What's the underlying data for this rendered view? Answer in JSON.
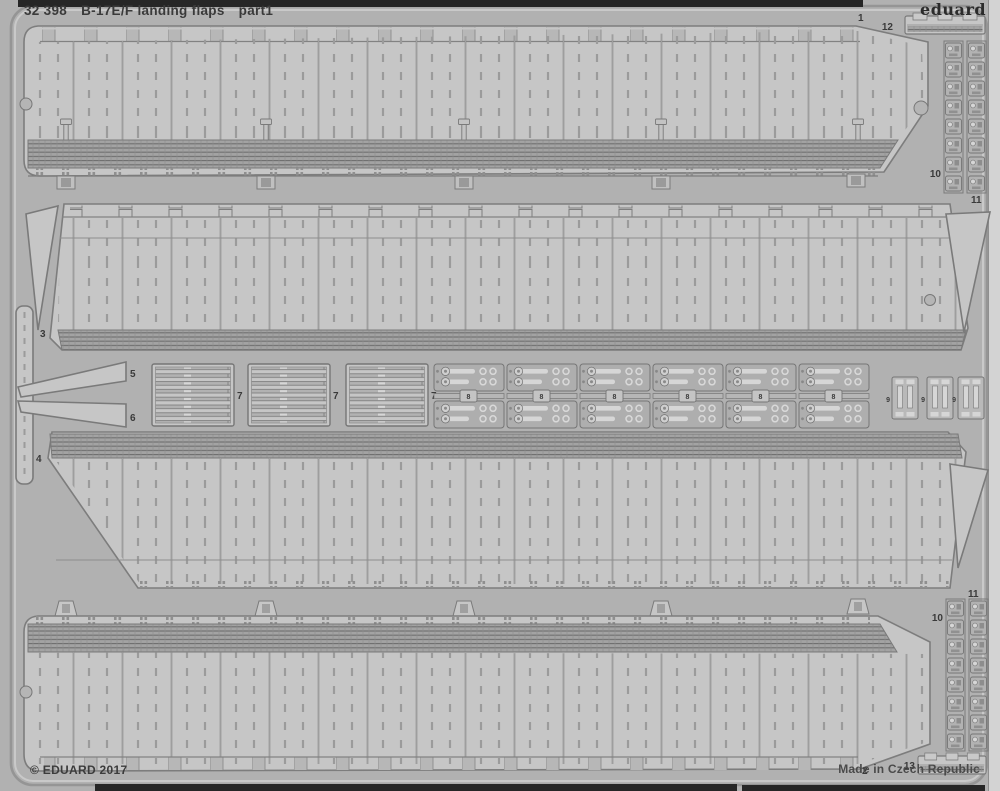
{
  "header": {
    "catalog_no": "32 398",
    "title": "B-17E/F landing flaps",
    "part_no": "part1"
  },
  "brand": {
    "logo": "eduard"
  },
  "footer": {
    "copyright": "© EDUARD 2017",
    "made_in": "Made in Czech Republic"
  },
  "part_labels": {
    "p1": "1",
    "p2": "2",
    "p3": "3",
    "p4": "4",
    "p5": "5",
    "p6": "6",
    "p7": "7",
    "p8": "8",
    "p9": "9",
    "p10": "10",
    "p11": "11",
    "p12": "12",
    "p13": "13"
  },
  "colors": {
    "background": "#b1b1b1",
    "sheet": "#b7b7b7",
    "part_fill": "#c6c6c6",
    "part_outline": "#7d7d7d",
    "rib_band": "#a3a3a3",
    "rib_line": "#6e6e6e",
    "detail_mid": "#b2b2b2",
    "detail_light": "#d6d6d6",
    "label": "#3a3a3a",
    "edge_dark": "#262626",
    "edge_light": "#d3d3d3"
  }
}
